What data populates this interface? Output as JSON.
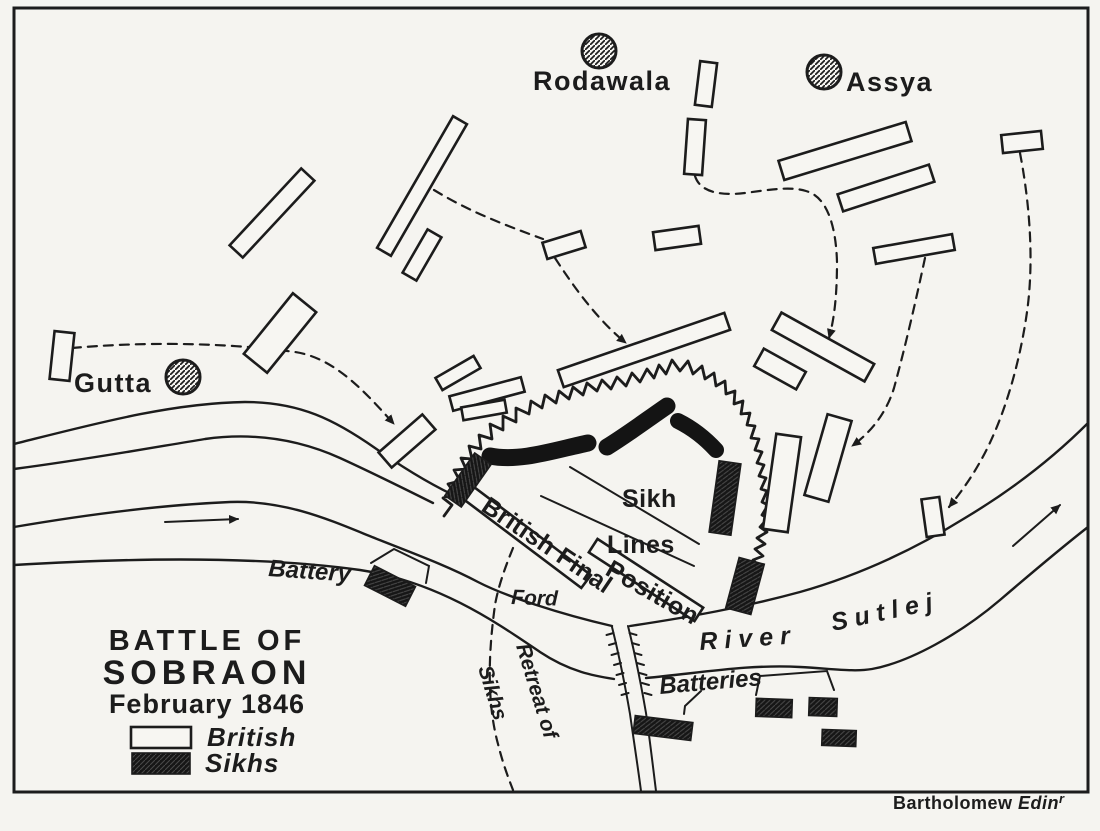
{
  "map": {
    "title": {
      "line1": "BATTLE OF",
      "line2": "SOBRAON",
      "line3": "February 1846"
    },
    "legend": {
      "british_label": "British",
      "sikhs_label": "Sikhs"
    },
    "signature": {
      "part1": "Bartholomew ",
      "part2": "Edin",
      "superscript": "r"
    },
    "labels": {
      "sikh_lines_line1": "Sikh",
      "sikh_lines_line2": "Lines",
      "british_final_line1": "British Final",
      "british_final_line2": "Position",
      "battery": "Battery",
      "batteries": "Batteries",
      "ford": "Ford",
      "river_word1": "River",
      "river_word2": "Sutlej",
      "retreat_line1": "Retreat of",
      "retreat_line2": "Sikhs"
    },
    "colors": {
      "ink": "#1c1c1c",
      "paper": "#f5f4f0",
      "sikh_fill": "#161616"
    },
    "villages": [
      {
        "name": "Rodawala",
        "circle": {
          "x": 599,
          "y": 51,
          "r": 17
        },
        "label": {
          "x": 533,
          "y": 90
        }
      },
      {
        "name": "Assya",
        "circle": {
          "x": 824,
          "y": 72,
          "r": 17
        },
        "label": {
          "x": 846,
          "y": 91
        }
      },
      {
        "name": "Gutta",
        "circle": {
          "x": 183,
          "y": 377,
          "r": 17
        },
        "label": {
          "x": 74,
          "y": 392
        }
      }
    ],
    "units": {
      "british": [
        {
          "x": 62,
          "y": 356,
          "w": 20,
          "h": 48,
          "rot": 6
        },
        {
          "x": 272,
          "y": 213,
          "w": 105,
          "h": 18,
          "rot": -47
        },
        {
          "x": 422,
          "y": 186,
          "w": 152,
          "h": 16,
          "rot": -60
        },
        {
          "x": 422,
          "y": 255,
          "w": 50,
          "h": 16,
          "rot": -60
        },
        {
          "x": 280,
          "y": 333,
          "w": 78,
          "h": 30,
          "rot": -51
        },
        {
          "x": 407,
          "y": 441,
          "w": 58,
          "h": 20,
          "rot": -41
        },
        {
          "x": 458,
          "y": 373,
          "w": 44,
          "h": 14,
          "rot": -30
        },
        {
          "x": 487,
          "y": 394,
          "w": 74,
          "h": 15,
          "rot": -15
        },
        {
          "x": 484,
          "y": 410,
          "w": 44,
          "h": 13,
          "rot": -10
        },
        {
          "x": 564,
          "y": 245,
          "w": 40,
          "h": 17,
          "rot": -17
        },
        {
          "x": 677,
          "y": 238,
          "w": 46,
          "h": 18,
          "rot": -8
        },
        {
          "x": 644,
          "y": 350,
          "w": 176,
          "h": 18,
          "rot": -19
        },
        {
          "x": 845,
          "y": 151,
          "w": 133,
          "h": 20,
          "rot": -17
        },
        {
          "x": 886,
          "y": 188,
          "w": 96,
          "h": 18,
          "rot": -18
        },
        {
          "x": 914,
          "y": 249,
          "w": 80,
          "h": 16,
          "rot": -10
        },
        {
          "x": 1022,
          "y": 142,
          "w": 40,
          "h": 18,
          "rot": -6
        },
        {
          "x": 823,
          "y": 347,
          "w": 106,
          "h": 20,
          "rot": 29
        },
        {
          "x": 780,
          "y": 369,
          "w": 48,
          "h": 20,
          "rot": 29
        },
        {
          "x": 695,
          "y": 147,
          "w": 18,
          "h": 55,
          "rot": 4
        },
        {
          "x": 706,
          "y": 84,
          "w": 17,
          "h": 44,
          "rot": 7
        },
        {
          "x": 782,
          "y": 483,
          "w": 25,
          "h": 96,
          "rot": 8
        },
        {
          "x": 828,
          "y": 458,
          "w": 25,
          "h": 84,
          "rot": 16
        },
        {
          "x": 933,
          "y": 517,
          "w": 18,
          "h": 38,
          "rot": -8
        },
        {
          "x": 527,
          "y": 537,
          "w": 148,
          "h": 16,
          "rot": 37
        },
        {
          "x": 646,
          "y": 580,
          "w": 126,
          "h": 16,
          "rot": 33
        }
      ],
      "sikh": [
        {
          "x": 468,
          "y": 480,
          "w": 52,
          "h": 20,
          "rot": -55
        },
        {
          "x": 725,
          "y": 498,
          "w": 22,
          "h": 72,
          "rot": 8
        },
        {
          "x": 745,
          "y": 586,
          "w": 26,
          "h": 52,
          "rot": 15
        },
        {
          "x": 390,
          "y": 586,
          "w": 46,
          "h": 22,
          "rot": 27
        },
        {
          "x": 663,
          "y": 728,
          "w": 58,
          "h": 18,
          "rot": 7
        },
        {
          "x": 774,
          "y": 708,
          "w": 36,
          "h": 18,
          "rot": 2
        },
        {
          "x": 823,
          "y": 707,
          "w": 28,
          "h": 18,
          "rot": 2
        },
        {
          "x": 839,
          "y": 738,
          "w": 34,
          "h": 16,
          "rot": 2
        }
      ]
    }
  }
}
